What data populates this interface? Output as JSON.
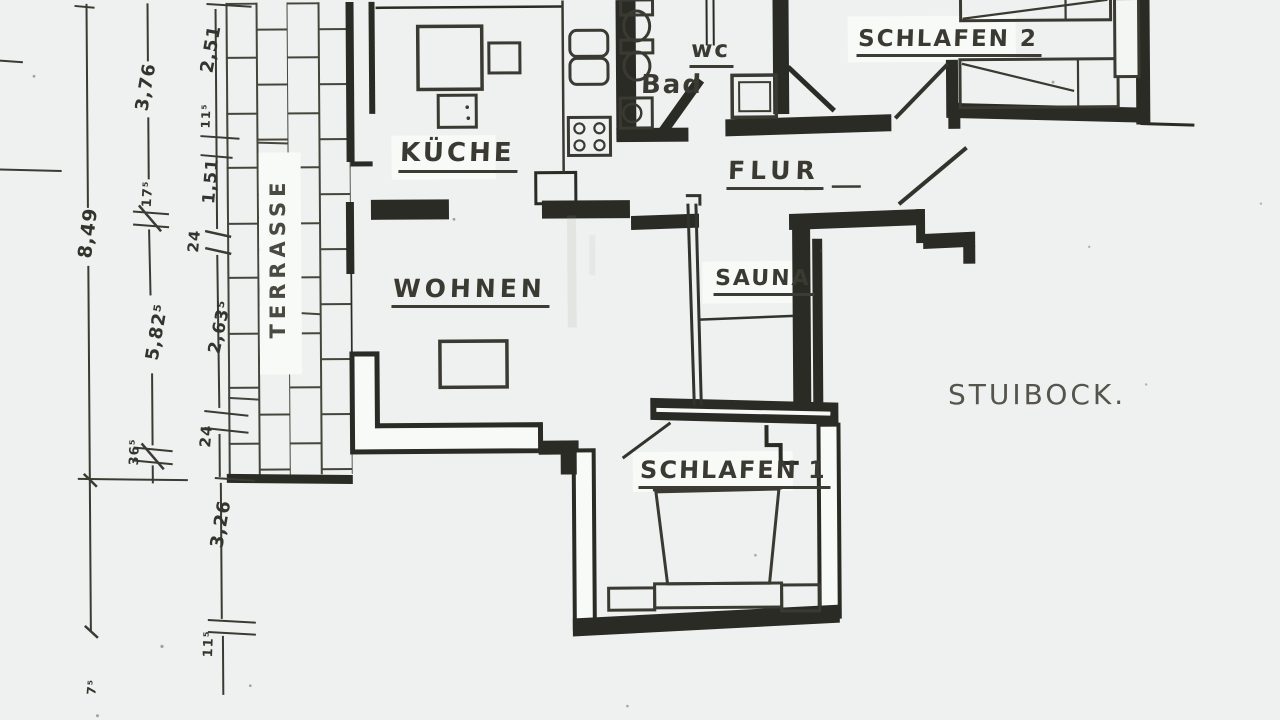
{
  "colors": {
    "paper": "#eef1ef",
    "ink": "#2b2b26",
    "pencil": "#45453c",
    "handwriting": "#55554d"
  },
  "rooms": {
    "kueche": "KÜCHE",
    "wohnen": "WOHNEN",
    "flur": "FLUR",
    "bad": "Bad",
    "wc": "wc",
    "sauna": "SAUNA",
    "schlafen1": "SCHLAFEN 1",
    "schlafen2": "SCHLAFEN 2",
    "terrasse": "TERRASSE"
  },
  "note": "STUIBOCK.",
  "dimensions": {
    "overall_height": "8,49",
    "d376": "3,76",
    "d175": "17⁵",
    "d5825": "5,82⁵",
    "d365": "36⁵",
    "d251": "2,51",
    "d115a": "11⁵",
    "d151": "1,51",
    "d24a": "24",
    "d2635": "2,63⁵",
    "d24b": "24",
    "d326": "3,26",
    "d115b": "11⁵",
    "d75": "7⁵"
  }
}
